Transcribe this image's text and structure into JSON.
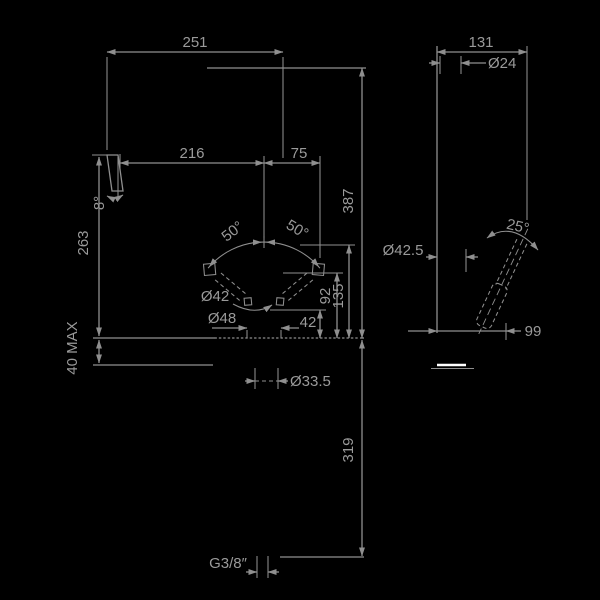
{
  "drawing": {
    "title": "faucet-dimension-drawing",
    "background": "#000000",
    "line_color": "#8f8f8f",
    "text_color": "#9a9a9a",
    "highlight_color": "#ffffff",
    "front_view": {
      "width_overall": "251",
      "width_spout_to_center": "216",
      "width_center_to_handle": "75",
      "height_overall": "387",
      "spout_angle": "8°",
      "spout_height": "263",
      "deck_thickness": "40 MAX",
      "handle_swing_left": "50°",
      "handle_swing_right": "50°",
      "handle_diameter": "Ø42",
      "base_diameter": "Ø48",
      "handle_low_height": "42",
      "handle_down_height": "92",
      "handle_up_height": "135",
      "shank_diameter": "Ø33.5",
      "hose_length": "319",
      "thread": "G3/8″"
    },
    "side_view": {
      "depth_overall": "131",
      "spout_diameter": "Ø24",
      "body_diameter": "Ø42.5",
      "handle_angle": "25°",
      "handle_reach": "99"
    }
  }
}
